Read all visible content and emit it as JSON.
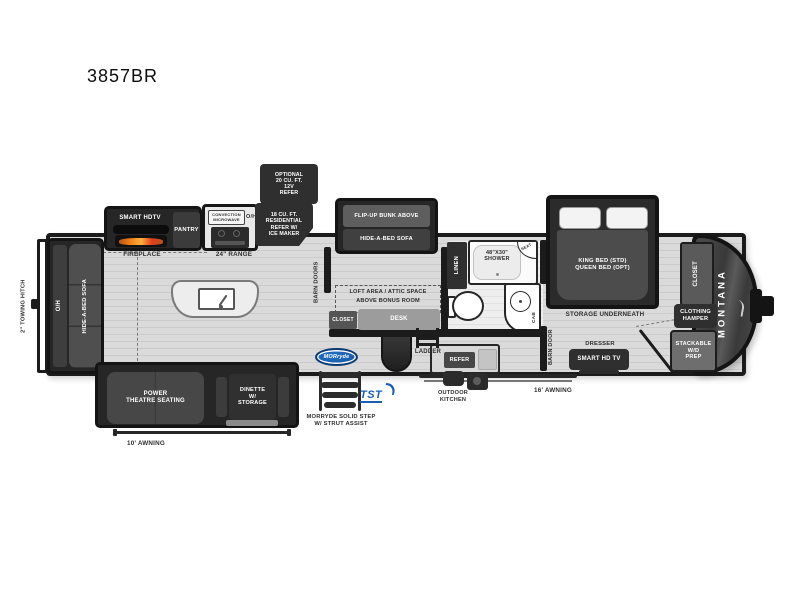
{
  "title": "3857BR",
  "brand": {
    "name": "MONTANA",
    "morryde_logo": "MORryde",
    "tst_logo": "TST"
  },
  "colors": {
    "morryde_blue": "#1660b0",
    "tst_blue": "#1a5fb4",
    "flame_orange": "#f08016",
    "body_dark": "#1b1b1b"
  },
  "labels": {
    "towing_hitch": "2\" TOWING HITCH",
    "rear_overhead": "O/H",
    "rear_sofa": "HIDE-A-BED SOFA",
    "smart_hdtv": "SMART HDTV",
    "fireplace": "FIREPLACE",
    "pantry": "PANTRY",
    "microwave_lines": [
      "CONVECTION",
      "MICROWAVE"
    ],
    "microwave_oh": "O/H",
    "range": "24\" RANGE",
    "residential_refer_lines": [
      "18 CU. FT.",
      "RESIDENTIAL",
      "REFER W/",
      "ICE MAKER"
    ],
    "optional_refer_lines": [
      "OPTIONAL",
      "20 CU. FT.",
      "12V",
      "REFER"
    ],
    "flip_up_bunk": "FLIP-UP BUNK ABOVE",
    "bunk_sofa": "HIDE-A-BED SOFA",
    "barn_doors": "BARN DOORS",
    "loft_lines": [
      "LOFT AREA / ATTIC SPACE",
      "ABOVE BONUS ROOM"
    ],
    "bonus_closet": "CLOSET",
    "desk": "DESK",
    "linen": "LINEN",
    "shower_lines": [
      "48\"X30\"",
      "SHOWER"
    ],
    "seat": "SEAT",
    "cab": "CAB",
    "barn_door": "BARN DOOR",
    "bed_lines": [
      "KING BED (STD)",
      "QUEEN BED (OPT)"
    ],
    "storage_underneath": "STORAGE UNDERNEATH",
    "dresser": "DRESSER",
    "smart_hd_tv": "SMART HD TV",
    "front_closet": "CLOSET",
    "hamper_lines": [
      "CLOTHING",
      "HAMPER"
    ],
    "wd_lines": [
      "STACKABLE",
      "W/D",
      "PREP"
    ],
    "theatre_lines": [
      "POWER",
      "THEATRE SEATING"
    ],
    "dinette_lines": [
      "DINETTE",
      "W/",
      "STORAGE"
    ],
    "awning_10": "10'  AWNING",
    "awning_16": "16'  AWNING",
    "ladder": "LADDER",
    "outdoor_refer": "REFER",
    "outdoor_kitchen_lines": [
      "OUTDOOR",
      "KITCHEN"
    ],
    "step_lines": [
      "MORRYDE SOLID STEP",
      "W/ STRUT ASSIST"
    ]
  }
}
